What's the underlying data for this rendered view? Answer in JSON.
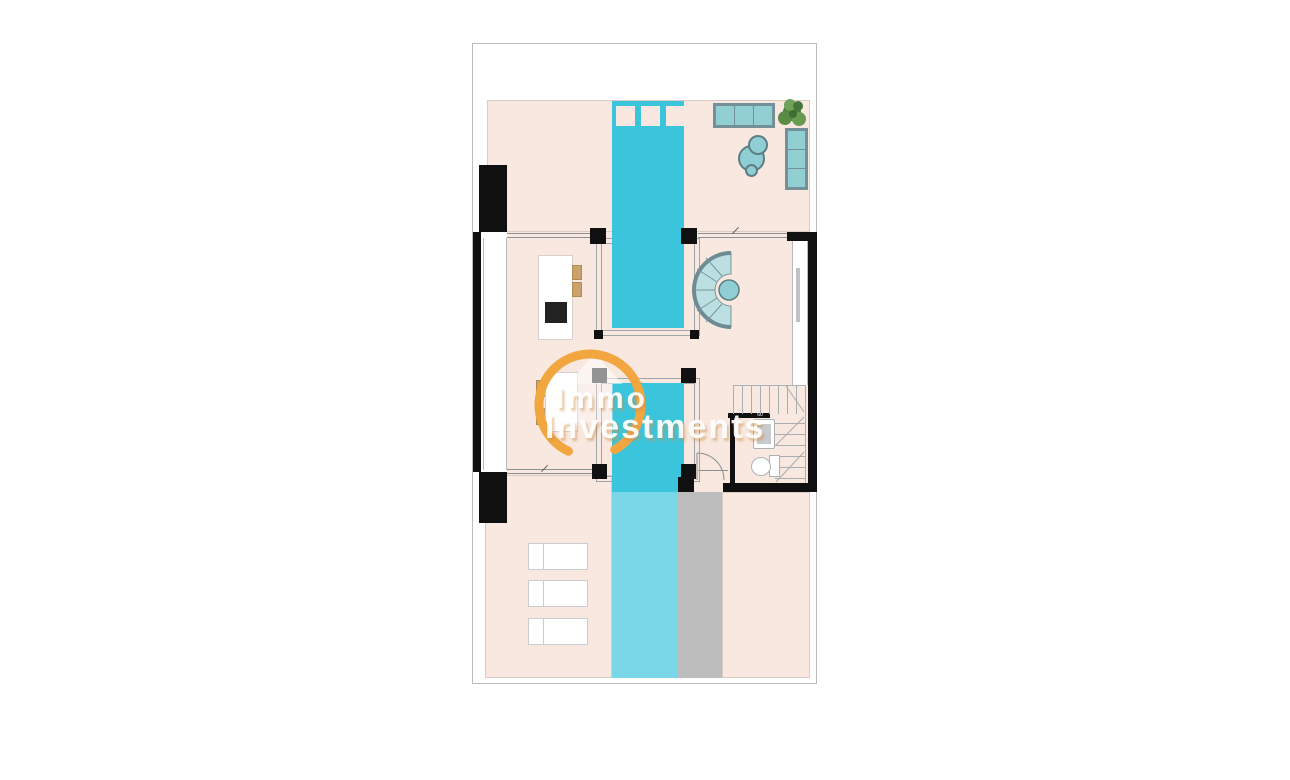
{
  "watermark": {
    "brand_line1": "Immo",
    "brand_line2": "Investments",
    "accent_color": "#F2A640"
  },
  "annotations": {
    "door_width_label": "60"
  },
  "colors": {
    "floor": "#F8E8E0",
    "pool_indoor": "#3BC5DC",
    "pool_outdoor": "#79D7E8",
    "walkway": "#BDBDBD",
    "wall": "#101010",
    "sofa_fill": "#92CFD3",
    "sofa_border": "#76909A",
    "wood": "#C9A36B",
    "plant": "#5A8B47",
    "boundary_line": "#B9BDC0",
    "watermark_text": "#FFFFFF"
  },
  "legend_icons": [
    "swimming-pool",
    "pool-steps",
    "sliding-glass-door",
    "three-seat-sofa",
    "coffee-tables",
    "plant",
    "curved-sofa",
    "round-table",
    "kitchen-island",
    "cooktop",
    "bar-stools",
    "dining-table",
    "dining-chairs",
    "staircase",
    "bathroom-door",
    "washbasin",
    "toilet",
    "sun-loungers",
    "walkway",
    "terrace"
  ]
}
